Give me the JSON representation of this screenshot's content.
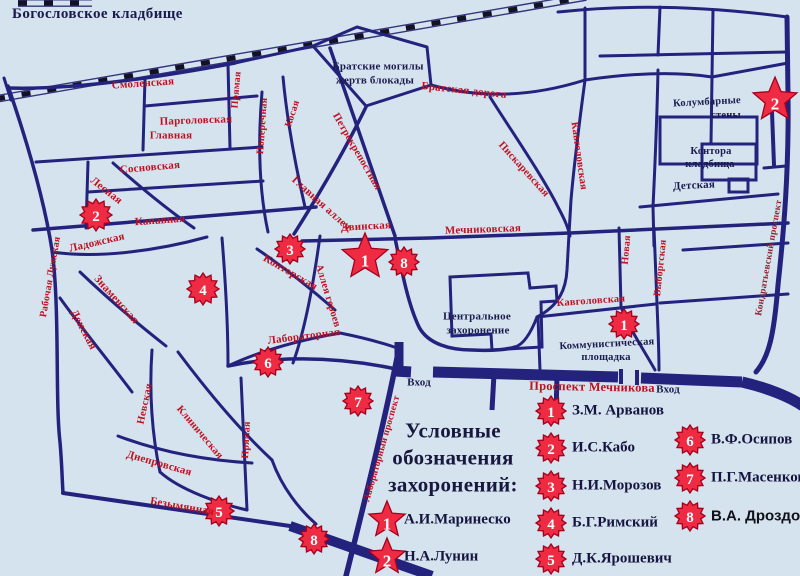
{
  "title": "Богословское кладбище",
  "colors": {
    "background": "#d5e3ef",
    "road": "#23237e",
    "street_red": "#c01020",
    "street_dark": "#93202e",
    "ink": "#1b1b4e",
    "star_fill": "#ee2b43",
    "star_stroke": "#a5001c",
    "star_number": "#ffffff"
  },
  "map_labels": [
    {
      "text": "Смоленская",
      "x": 143,
      "y": 84,
      "rot": -4,
      "kind": "street"
    },
    {
      "text": "Парголовская",
      "x": 196,
      "y": 121,
      "rot": -2,
      "kind": "street"
    },
    {
      "text": "Главная",
      "x": 171,
      "y": 136,
      "rot": 0,
      "kind": "street"
    },
    {
      "text": "Сосновская",
      "x": 150,
      "y": 168,
      "rot": -5,
      "kind": "street"
    },
    {
      "text": "Канавная",
      "x": 160,
      "y": 221,
      "rot": -4,
      "kind": "street"
    },
    {
      "text": "Лесная",
      "x": 106,
      "y": 191,
      "rot": 38,
      "kind": "street"
    },
    {
      "text": "Ладожская",
      "x": 97,
      "y": 243,
      "rot": -13,
      "kind": "street"
    },
    {
      "text": "Рабочая Лужская",
      "x": 51,
      "y": 277,
      "rot": -80,
      "kind": "street",
      "fs": 10
    },
    {
      "text": "Знаменская",
      "x": 116,
      "y": 300,
      "rot": 48,
      "kind": "street"
    },
    {
      "text": "Донская",
      "x": 83,
      "y": 330,
      "rot": 62,
      "kind": "street"
    },
    {
      "text": "Прямая",
      "x": 237,
      "y": 90,
      "rot": -85,
      "kind": "street",
      "fs": 10
    },
    {
      "text": "Поперечная",
      "x": 263,
      "y": 126,
      "rot": -86,
      "kind": "street",
      "fs": 10
    },
    {
      "text": "Косая",
      "x": 293,
      "y": 114,
      "rot": -72,
      "kind": "street",
      "fs": 10
    },
    {
      "text": "Петрокрепостная",
      "x": 356,
      "y": 152,
      "rot": 60,
      "kind": "street",
      "fs": 10.5
    },
    {
      "text": "Главная аллея",
      "x": 321,
      "y": 204,
      "rot": 42,
      "kind": "street"
    },
    {
      "text": "Двинская",
      "x": 366,
      "y": 227,
      "rot": -3,
      "kind": "street"
    },
    {
      "text": "Мечниковская",
      "x": 483,
      "y": 230,
      "rot": -2,
      "kind": "street"
    },
    {
      "text": "Конторская",
      "x": 290,
      "y": 273,
      "rot": 30,
      "kind": "street"
    },
    {
      "text": "Аллея героев",
      "x": 327,
      "y": 296,
      "rot": 73,
      "kind": "street",
      "fs": 10.5
    },
    {
      "text": "Лабораторная",
      "x": 304,
      "y": 337,
      "rot": -7,
      "kind": "street"
    },
    {
      "text": "Прямая",
      "x": 247,
      "y": 440,
      "rot": -87,
      "kind": "street",
      "fs": 10
    },
    {
      "text": "Невская",
      "x": 146,
      "y": 404,
      "rot": -78,
      "kind": "street",
      "fs": 10.5
    },
    {
      "text": "Клиническая",
      "x": 199,
      "y": 433,
      "rot": 50,
      "kind": "street",
      "fs": 10.5
    },
    {
      "text": "Днепровская",
      "x": 159,
      "y": 464,
      "rot": 16,
      "kind": "street"
    },
    {
      "text": "Безымянная",
      "x": 182,
      "y": 507,
      "rot": 10,
      "kind": "street"
    },
    {
      "text": "Лабораторный проспект",
      "x": 383,
      "y": 449,
      "rot": -74,
      "kind": "street",
      "fs": 9.5
    },
    {
      "text": "Проспект Мечникова",
      "x": 592,
      "y": 387,
      "rot": 1,
      "kind": "street",
      "fs": 12.5
    },
    {
      "text": "Братская дорога",
      "x": 464,
      "y": 91,
      "rot": 6,
      "kind": "street"
    },
    {
      "text": "Пискаревская",
      "x": 523,
      "y": 170,
      "rot": 48,
      "kind": "street",
      "fs": 10.5
    },
    {
      "text": "Кавголовская",
      "x": 578,
      "y": 156,
      "rot": 82,
      "kind": "street",
      "fs": 10.5
    },
    {
      "text": "Кавголовская",
      "x": 591,
      "y": 302,
      "rot": -4,
      "kind": "street",
      "fs": 10.5
    },
    {
      "text": "Новая",
      "x": 627,
      "y": 250,
      "rot": -85,
      "kind": "street",
      "fs": 10
    },
    {
      "text": "Выборгская",
      "x": 661,
      "y": 268,
      "rot": -84,
      "kind": "street",
      "fs": 10
    },
    {
      "text": "Кондратьевский проспект",
      "x": 770,
      "y": 258,
      "rot": -80,
      "kind": "street-dark",
      "fs": 9.5
    },
    {
      "text": "Детская",
      "x": 694,
      "y": 186,
      "rot": -3,
      "kind": "place"
    },
    {
      "text": "Братские могилы",
      "x": 378,
      "y": 67,
      "rot": 0,
      "kind": "place"
    },
    {
      "text": "жертв блокады",
      "x": 375,
      "y": 81,
      "rot": 0,
      "kind": "place"
    },
    {
      "text": "Колумбарные",
      "x": 707,
      "y": 103,
      "rot": -3,
      "kind": "place",
      "fs": 10.5
    },
    {
      "text": "стены",
      "x": 726,
      "y": 116,
      "rot": 0,
      "kind": "place",
      "fs": 10.5
    },
    {
      "text": "Контора",
      "x": 711,
      "y": 152,
      "rot": 0,
      "kind": "place",
      "fs": 10.5
    },
    {
      "text": "кладбища",
      "x": 710,
      "y": 165,
      "rot": 0,
      "kind": "place",
      "fs": 10.5
    },
    {
      "text": "Центральное",
      "x": 477,
      "y": 317,
      "rot": 0,
      "kind": "place"
    },
    {
      "text": "захоронение",
      "x": 478,
      "y": 331,
      "rot": 0,
      "kind": "place"
    },
    {
      "text": "Коммунистическая",
      "x": 607,
      "y": 345,
      "rot": -3,
      "kind": "place",
      "fs": 10.5
    },
    {
      "text": "площадка",
      "x": 606,
      "y": 358,
      "rot": 0,
      "kind": "place",
      "fs": 10.5
    },
    {
      "text": "Вход",
      "x": 419,
      "y": 383,
      "rot": 0,
      "kind": "place"
    },
    {
      "text": "Вход",
      "x": 668,
      "y": 390,
      "rot": 0,
      "kind": "place"
    }
  ],
  "map_stars": [
    {
      "type": "star",
      "number": "1",
      "x": 365,
      "y": 257,
      "r": 24
    },
    {
      "type": "star",
      "number": "2",
      "x": 775,
      "y": 100,
      "r": 23
    },
    {
      "type": "burst",
      "number": "2",
      "x": 96,
      "y": 215,
      "r": 16
    },
    {
      "type": "burst",
      "number": "3",
      "x": 290,
      "y": 249,
      "r": 15
    },
    {
      "type": "burst",
      "number": "8",
      "x": 404,
      "y": 262,
      "r": 15
    },
    {
      "type": "burst",
      "number": "4",
      "x": 203,
      "y": 289,
      "r": 16
    },
    {
      "type": "burst",
      "number": "6",
      "x": 268,
      "y": 362,
      "r": 15
    },
    {
      "type": "burst",
      "number": "7",
      "x": 358,
      "y": 401,
      "r": 15
    },
    {
      "type": "burst",
      "number": "5",
      "x": 219,
      "y": 511,
      "r": 15
    },
    {
      "type": "burst",
      "number": "8",
      "x": 314,
      "y": 539,
      "r": 15
    },
    {
      "type": "burst",
      "number": "1",
      "x": 624,
      "y": 324,
      "r": 15
    }
  ],
  "legend": {
    "heading_lines": [
      "Условные",
      "обозначения",
      "захоронений:"
    ],
    "named_star_entries": [
      {
        "number": "1",
        "name": "А.И.Маринеско"
      },
      {
        "number": "2",
        "name": "Н.А.Лунин"
      }
    ],
    "burst_entries": [
      {
        "number": "1",
        "name": "З.М. Арванов"
      },
      {
        "number": "2",
        "name": "И.С.Кабо"
      },
      {
        "number": "3",
        "name": "Н.И.Морозов"
      },
      {
        "number": "4",
        "name": "Б.Г.Римский"
      },
      {
        "number": "5",
        "name": "Д.К.Ярошевич"
      },
      {
        "number": "6",
        "name": "В.Ф.Осипов"
      },
      {
        "number": "7",
        "name": "П.Г.Масенков"
      },
      {
        "number": "8",
        "name": "В.А. Дроздов"
      }
    ]
  }
}
